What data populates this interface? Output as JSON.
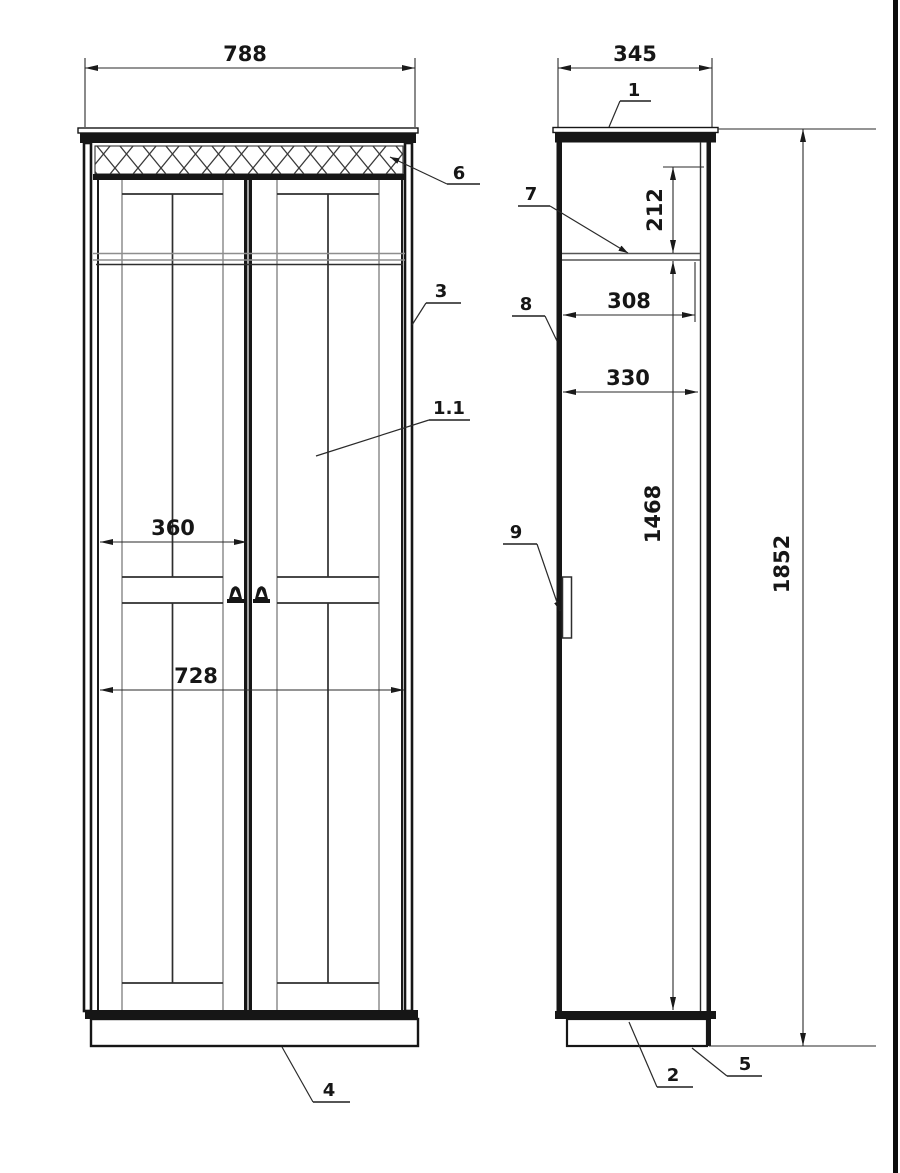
{
  "front_view": {
    "dims": {
      "overall_width": "788",
      "door_width": "360",
      "opening_width": "728"
    },
    "callouts": {
      "frieze": "6",
      "side_panel": "3",
      "door_facade": "1.1",
      "plinth": "4"
    }
  },
  "side_view": {
    "dims": {
      "overall_depth": "345",
      "shelf_drop": "212",
      "shelf_depth": "308",
      "interior_depth": "330",
      "interior_height": "1468",
      "overall_height": "1852"
    },
    "callouts": {
      "top_panel": "1",
      "shelf": "7",
      "side_panel": "8",
      "handle": "9",
      "bottom_panel": "2",
      "plinth": "5"
    }
  },
  "colors": {
    "ink": "#161616",
    "panel_line": "#8e8e8e",
    "dimension_line": "#2a2a2a",
    "background": "#ffffff",
    "right_border_strip": "#0c0c0c"
  }
}
